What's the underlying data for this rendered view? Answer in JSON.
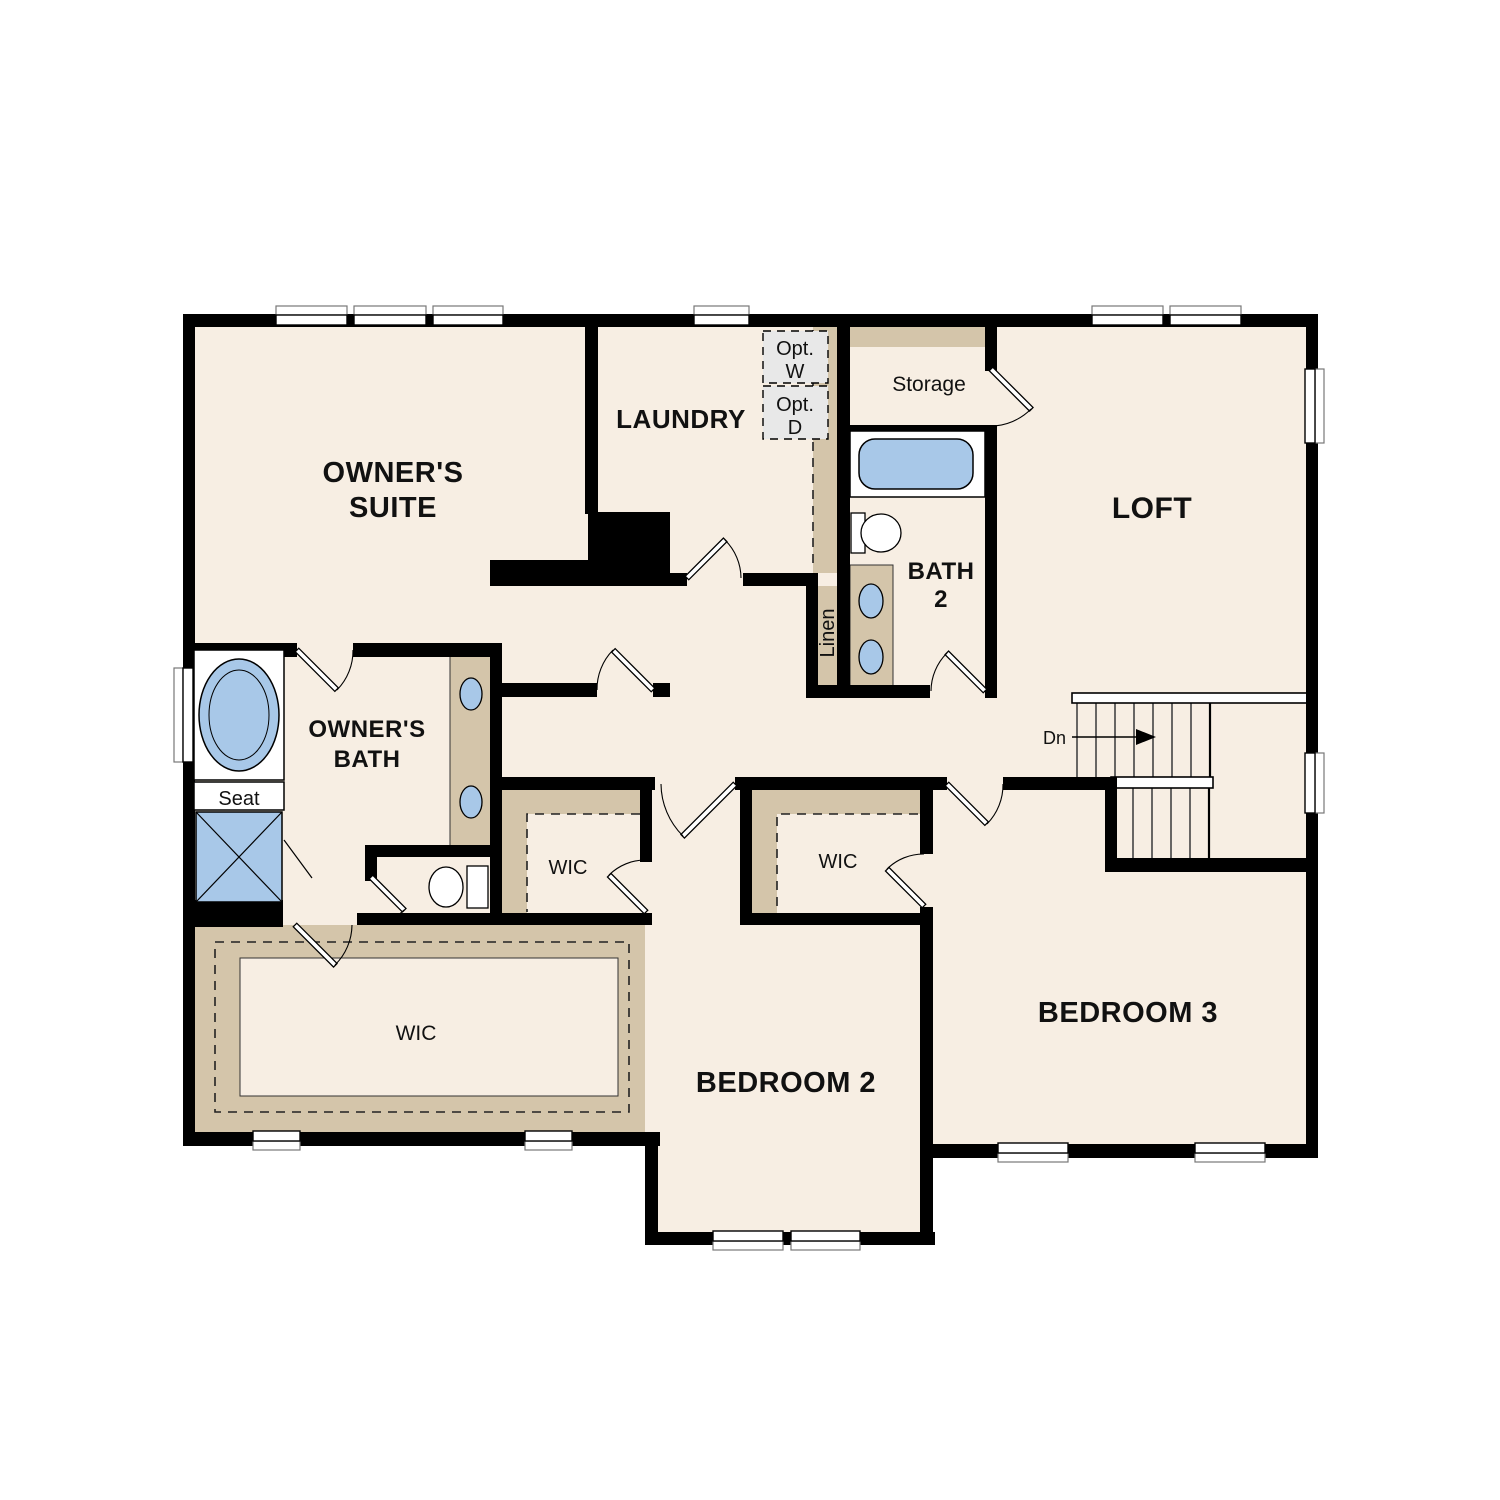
{
  "plan": {
    "floor_name": "Second Floor Plan",
    "rooms": {
      "owners_suite": {
        "line1": "OWNER'S",
        "line2": "SUITE"
      },
      "laundry": {
        "label": "LAUNDRY"
      },
      "loft": {
        "label": "LOFT"
      },
      "storage": {
        "label": "Storage"
      },
      "bath2": {
        "line1": "BATH",
        "line2": "2"
      },
      "owners_bath": {
        "line1": "OWNER'S",
        "line2": "BATH"
      },
      "bedroom2": {
        "label": "BEDROOM 2"
      },
      "bedroom3": {
        "label": "BEDROOM 3"
      },
      "wic_owner": {
        "label": "WIC"
      },
      "wic_bedroom2": {
        "label": "WIC"
      },
      "wic_bedroom3": {
        "label": "WIC"
      },
      "linen": {
        "label": "Linen"
      }
    },
    "fixtures": {
      "tub_seat": "Seat"
    },
    "options": {
      "washer": {
        "line1": "Opt.",
        "line2": "W"
      },
      "dryer": {
        "line1": "Opt.",
        "line2": "D"
      }
    },
    "stairs": {
      "down_label": "Dn"
    },
    "colors": {
      "floor": "#f7eee3",
      "closet_tan": "#d4c5aa",
      "fixture_blue": "#a8c8e8",
      "wall_black": "#000000",
      "option_gray": "#e8e8e8"
    }
  }
}
